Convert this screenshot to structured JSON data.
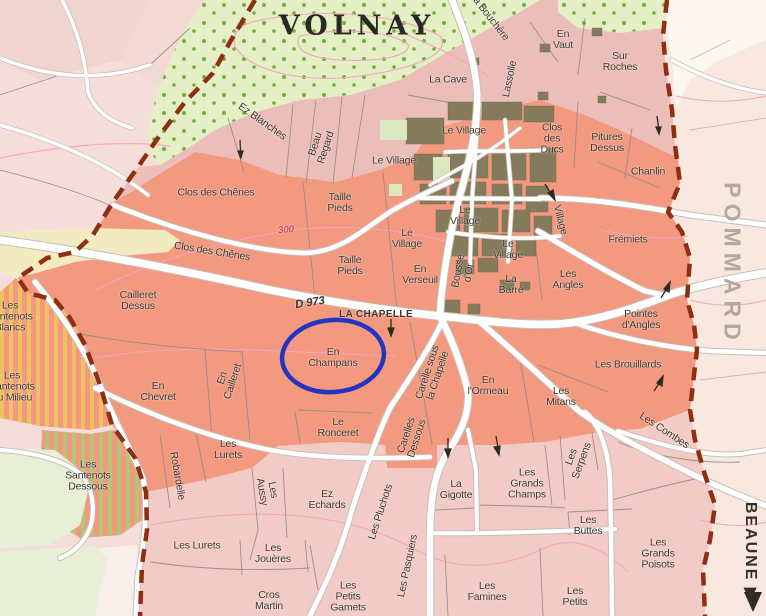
{
  "map": {
    "region_title": "VOLNAY",
    "neighbor_right": "POMMARD",
    "neighbor_bottom_right": "BEAUNE ▶",
    "road_label": "D 973",
    "place_label": "LA CHAPELLE",
    "contour_label": "300",
    "highlighted_parcel": "En Champans",
    "colors": {
      "premier_cru_salmon": "#F2997F",
      "village_pink": "#F2CBC6",
      "north_pink": "#ECBEB9",
      "outside_pale": "#F5DEDA",
      "pommard_pale": "#F8E8DF",
      "wood_green": "#E4EFC6",
      "wood_dot": "#77AB40",
      "building_brown": "#857B5C",
      "boundary_red": "#8E2F12",
      "highlight_blue": "#2433C0",
      "contour_pink": "#F2A6BB",
      "stripe_yellow": "#EFC25F",
      "stripe_green": "#B3C677",
      "cream_parcel": "#F2EBC2",
      "label_ink": "#3D362E",
      "pommard_text": "#B5A79B"
    }
  },
  "labels": [
    {
      "id": "ez-blanches",
      "t": "Ez Blanches",
      "x": 262,
      "y": 122,
      "r": 35
    },
    {
      "id": "beau-regard",
      "t": "Beau\nRegard",
      "x": 321,
      "y": 146,
      "r": -72
    },
    {
      "id": "le-village-nw",
      "t": "Le Village",
      "x": 394,
      "y": 161,
      "r": 0
    },
    {
      "id": "la-cave",
      "t": "La Cave",
      "x": 448,
      "y": 80,
      "r": 0
    },
    {
      "id": "la-bouchere",
      "t": "La Bouchère",
      "x": 489,
      "y": 17,
      "r": 52
    },
    {
      "id": "lassolle",
      "t": "Lassolle",
      "x": 510,
      "y": 79,
      "r": -78
    },
    {
      "id": "en-vaut",
      "t": "En\nVaut",
      "x": 563,
      "y": 40,
      "r": 0
    },
    {
      "id": "sur-roches",
      "t": "Sur\nRoches",
      "x": 620,
      "y": 62,
      "r": 0
    },
    {
      "id": "le-village-top",
      "t": "Le Village",
      "x": 464,
      "y": 131,
      "r": 0
    },
    {
      "id": "clos-des-ducs",
      "t": "Clos\ndes\nDucs",
      "x": 552,
      "y": 139,
      "r": 0
    },
    {
      "id": "pitures-dessus",
      "t": "Pitures\nDessus",
      "x": 607,
      "y": 143,
      "r": 0
    },
    {
      "id": "chanlin",
      "t": "Chanlin",
      "x": 648,
      "y": 172,
      "r": 0
    },
    {
      "id": "clos-des-chenes-1",
      "t": "Clos des Chênes",
      "x": 216,
      "y": 193,
      "r": 0
    },
    {
      "id": "taille-pieds-1",
      "t": "Taille\nPieds",
      "x": 340,
      "y": 203,
      "r": 0
    },
    {
      "id": "clos-des-chenes-2",
      "t": "Clos des Chênes",
      "x": 212,
      "y": 252,
      "r": 9
    },
    {
      "id": "contour-300",
      "t": "300",
      "x": 286,
      "y": 231,
      "r": -4,
      "c": "contour"
    },
    {
      "id": "taille-pieds-2",
      "t": "Taille\nPieds",
      "x": 350,
      "y": 266,
      "r": 0
    },
    {
      "id": "le-village-w",
      "t": "Le\nVillage",
      "x": 407,
      "y": 239,
      "r": 0
    },
    {
      "id": "le-village-c",
      "t": "Le\nVillage",
      "x": 465,
      "y": 216,
      "r": 0
    },
    {
      "id": "le-village-e",
      "t": "Le\nVillage",
      "x": 508,
      "y": 250,
      "r": 0
    },
    {
      "id": "en-verseuil",
      "t": "En\nVerseuil",
      "x": 420,
      "y": 275,
      "r": 0
    },
    {
      "id": "bousse-dor",
      "t": "Bousse\nd'Or",
      "x": 464,
      "y": 272,
      "r": -80
    },
    {
      "id": "la-barre",
      "t": "La\nBarre",
      "x": 511,
      "y": 285,
      "r": 0
    },
    {
      "id": "les-angles",
      "t": "Les\nAngles",
      "x": 568,
      "y": 280,
      "r": 0
    },
    {
      "id": "village-rot",
      "t": "Village",
      "x": 560,
      "y": 220,
      "r": 75
    },
    {
      "id": "fremiets",
      "t": "Frémiets",
      "x": 628,
      "y": 240,
      "r": 0
    },
    {
      "id": "pointes-dangles",
      "t": "Pointes\nd'Angles",
      "x": 641,
      "y": 320,
      "r": 0
    },
    {
      "id": "les-brouillards",
      "t": "Les Brouillards",
      "x": 628,
      "y": 365,
      "r": 0
    },
    {
      "id": "cailleret-dessus",
      "t": "Cailleret\nDessus",
      "x": 138,
      "y": 301,
      "r": 0
    },
    {
      "id": "santenots-blancs",
      "t": "Les\nSantenots\nBlancs",
      "x": 10,
      "y": 317,
      "r": 0
    },
    {
      "id": "santenots-milieu",
      "t": "Les\nSantenots\ndu Milieu",
      "x": 12,
      "y": 387,
      "r": 0
    },
    {
      "id": "santenots-dessous",
      "t": "Les\nSantenots\nDessous",
      "x": 88,
      "y": 476,
      "r": 0
    },
    {
      "id": "en-chevret",
      "t": "En\nChevret",
      "x": 158,
      "y": 392,
      "r": 0
    },
    {
      "id": "en-cailleret",
      "t": "En\nCailleret",
      "x": 228,
      "y": 380,
      "r": -72
    },
    {
      "id": "la-chapelle",
      "t": "LA CHAPELLE",
      "x": 376,
      "y": 315,
      "r": 0,
      "c": "caps"
    },
    {
      "id": "d973",
      "t": "D 973",
      "x": 310,
      "y": 303,
      "r": -9,
      "c": "road"
    },
    {
      "id": "en-champans",
      "t": "En\nChampans",
      "x": 333,
      "y": 358,
      "r": 0
    },
    {
      "id": "carelle-sous",
      "t": "Carelle sous\nla Chapelle",
      "x": 433,
      "y": 374,
      "r": -72
    },
    {
      "id": "en-lormeau",
      "t": "En\nl'Ormeau",
      "x": 488,
      "y": 386,
      "r": 0
    },
    {
      "id": "les-mitans",
      "t": "Les\nMitans",
      "x": 561,
      "y": 397,
      "r": 0
    },
    {
      "id": "robardelle",
      "t": "Robardelle",
      "x": 177,
      "y": 476,
      "r": 80
    },
    {
      "id": "les-lurets-1",
      "t": "Les\nLurets",
      "x": 228,
      "y": 450,
      "r": 0
    },
    {
      "id": "le-ronceret",
      "t": "Le\nRonceret",
      "x": 338,
      "y": 428,
      "r": 0
    },
    {
      "id": "carelles-dessous",
      "t": "Carelles\nDessous",
      "x": 412,
      "y": 437,
      "r": -72
    },
    {
      "id": "les-combes",
      "t": "Les Combes",
      "x": 664,
      "y": 431,
      "r": 33
    },
    {
      "id": "les-aussy",
      "t": "Les\nAussy",
      "x": 267,
      "y": 491,
      "r": 80
    },
    {
      "id": "ez-echards",
      "t": "Ez\nEchards",
      "x": 327,
      "y": 500,
      "r": 0
    },
    {
      "id": "les-lurets-2",
      "t": "Les Lurets",
      "x": 197,
      "y": 546,
      "r": 0
    },
    {
      "id": "les-joueres",
      "t": "Les\nJouères",
      "x": 273,
      "y": 554,
      "r": 0
    },
    {
      "id": "les-pluchots",
      "t": "Les Pluchots",
      "x": 381,
      "y": 512,
      "r": -72
    },
    {
      "id": "les-pasquiers",
      "t": "Les Pasquiers",
      "x": 408,
      "y": 566,
      "r": -78
    },
    {
      "id": "la-gigotte",
      "t": "La\nGigotte",
      "x": 456,
      "y": 490,
      "r": 0
    },
    {
      "id": "les-grands-champs",
      "t": "Les\nGrands\nChamps",
      "x": 527,
      "y": 484,
      "r": 0
    },
    {
      "id": "les-serpens",
      "t": "Les\nSerpens",
      "x": 577,
      "y": 459,
      "r": -70
    },
    {
      "id": "les-buttes",
      "t": "Les\nButtes",
      "x": 588,
      "y": 526,
      "r": 0
    },
    {
      "id": "les-grands-poisots",
      "t": "Les\nGrands\nPoisots",
      "x": 658,
      "y": 554,
      "r": 0
    },
    {
      "id": "les-famines",
      "t": "Les\nFamines",
      "x": 487,
      "y": 592,
      "r": 0
    },
    {
      "id": "cros-martin",
      "t": "Cros\nMartin",
      "x": 269,
      "y": 601,
      "r": 0
    },
    {
      "id": "les-petits-gamets",
      "t": "Les\nPetits\nGamets",
      "x": 348,
      "y": 597,
      "r": 0
    },
    {
      "id": "les-petits",
      "t": "Les\nPetits",
      "x": 575,
      "y": 597,
      "r": 0
    }
  ]
}
